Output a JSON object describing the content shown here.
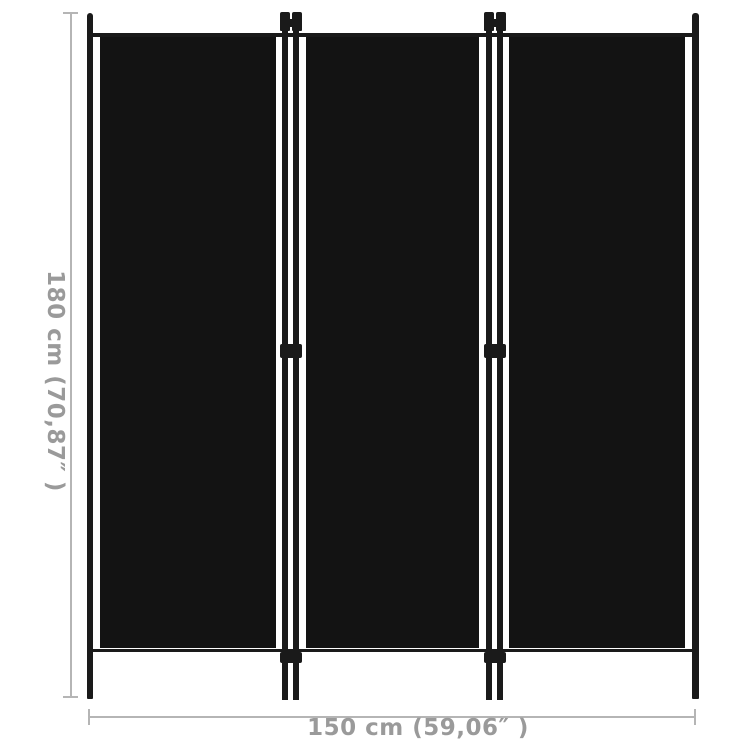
{
  "diagram": {
    "product": "3-panel room divider",
    "panel_count": 3
  },
  "dimensions": {
    "height": {
      "cm": "180",
      "label": "180 cm (70,87″ )"
    },
    "width": {
      "cm": "150",
      "label": "150 cm (59,06″ )"
    }
  },
  "colors": {
    "background": "#ffffff",
    "panel_fabric": "#131313",
    "frame": "#1a1a1a",
    "dimension_line": "#b5b5b5",
    "dimension_text": "#9a9a9a"
  }
}
